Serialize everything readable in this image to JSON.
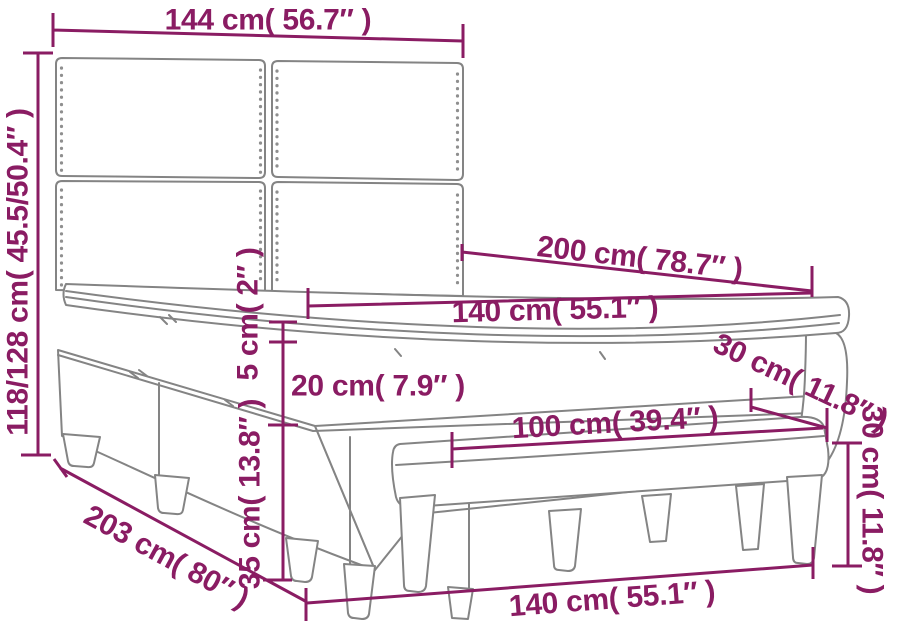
{
  "diagram": {
    "subject": "Box spring bed with tufted headboard and bench — dimension drawing",
    "background_color": "#ffffff",
    "accent_color": "#8a1c63",
    "drawing_line_color": "#848484"
  },
  "dimensions": {
    "headboard_width": {
      "text": "144 cm( 56.7″ )",
      "cm": "144",
      "inches": "56.7"
    },
    "headboard_height": {
      "text": "118/128 cm( 45.5/50.4″ )",
      "cm": "118/128",
      "inches": "45.5/50.4"
    },
    "bed_length": {
      "text": "200 cm( 78.7″ )",
      "cm": "200",
      "inches": "78.7"
    },
    "mattress_width": {
      "text": "140 cm( 55.1″ )",
      "cm": "140",
      "inches": "55.1"
    },
    "topper_thickness": {
      "text": "5 cm( 2″ )",
      "cm": "5",
      "inches": "2"
    },
    "mattress_thickness": {
      "text": "20 cm( 7.9″ )",
      "cm": "20",
      "inches": "7.9"
    },
    "base_height": {
      "text": "35 cm( 13.8″ )",
      "cm": "35",
      "inches": "13.8"
    },
    "bench_length": {
      "text": "100 cm( 39.4″ )",
      "cm": "100",
      "inches": "39.4"
    },
    "bench_depth": {
      "text": "30 cm( 11.8″ )",
      "cm": "30",
      "inches": "11.8"
    },
    "bench_height": {
      "text": "30 cm( 11.8″ )",
      "cm": "30",
      "inches": "11.8"
    },
    "bed_base_length": {
      "text": "203 cm( 80″ )",
      "cm": "203",
      "inches": "80"
    },
    "bed_width_front": {
      "text": "140 cm( 55.1″ )",
      "cm": "140",
      "inches": "55.1"
    }
  }
}
